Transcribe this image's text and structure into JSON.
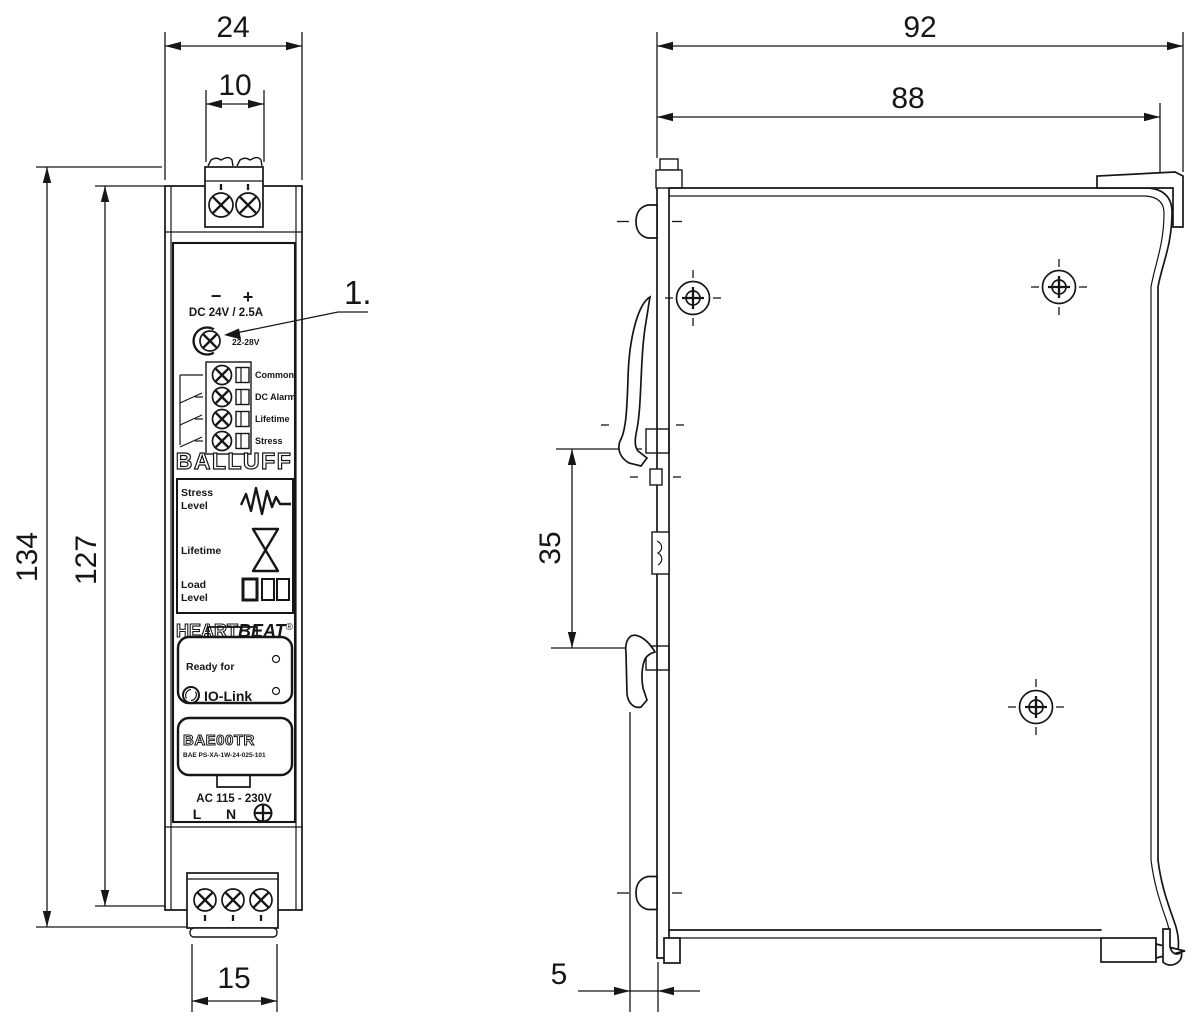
{
  "front_view": {
    "dim_width_overall": "24",
    "dim_width_terminal": "10",
    "dim_height_overall": "134",
    "dim_height_body": "127",
    "dim_width_bottom_terminal": "15",
    "callout_1": "1.",
    "panel": {
      "polarity_minus": "−",
      "polarity_plus": "+",
      "output_rating": "DC 24V / 2.5A",
      "voltage_adjust_range": "22-28V",
      "relay_outputs": [
        "Common",
        "DC Alarm",
        "Lifetime",
        "Stress"
      ],
      "brand": "BALLUFF",
      "indicator_stress_line1": "Stress",
      "indicator_stress_line2": "Level",
      "indicator_lifetime": "Lifetime",
      "indicator_load_line1": "Load",
      "indicator_load_line2": "Level",
      "heartbeat_part1": "HEART",
      "heartbeat_part2": "BEAT",
      "heartbeat_reg": "®",
      "ready_for": "Ready for",
      "iolink": "IO-Link",
      "model": "BAE00TR",
      "part_number": "BAE PS-XA-1W-24-025-101",
      "input_rating": "AC 115 - 230V",
      "terminal_l": "L",
      "terminal_n": "N"
    }
  },
  "side_view": {
    "dim_depth_overall": "92",
    "dim_depth_housing": "88",
    "dim_din_rail_slot": "35",
    "dim_clip_protrusion": "5"
  }
}
